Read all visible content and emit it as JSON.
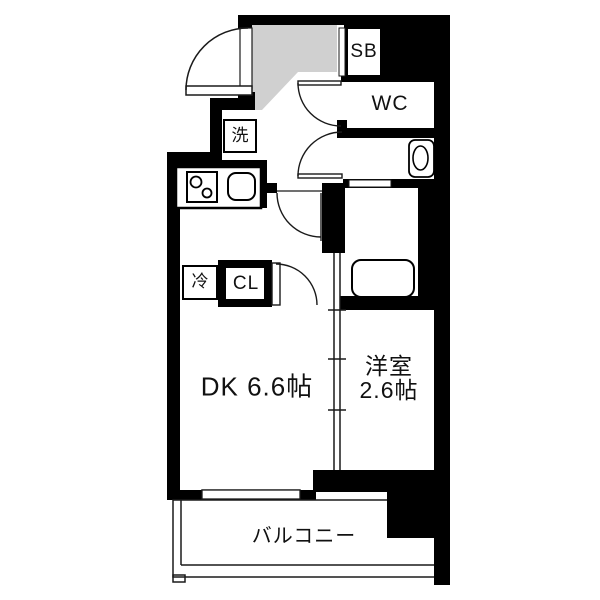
{
  "document": {
    "type": "apartment-floor-plan",
    "orientation": "1DK layout with balcony at bottom"
  },
  "colors": {
    "wall": "#000000",
    "genkan_gray": "#d0d0d0",
    "line": "#1a1a1a",
    "background": "#ffffff"
  },
  "rooms": {
    "dk": {
      "label": "DK 6.6帖"
    },
    "western_room": {
      "line1": "洋室",
      "line2": "2.6帖"
    },
    "balcony": {
      "label": "バルコニー"
    },
    "wc": {
      "label": "WC"
    },
    "shoe_box": {
      "label": "SB"
    },
    "laundry": {
      "label": "洗"
    },
    "refrigerator": {
      "label": "冷"
    },
    "closet": {
      "label": "CL"
    }
  },
  "fixtures": [
    "entrance-genkan-area",
    "entrance-door-swing",
    "wc-door-swing",
    "washroom-door-swing",
    "dk-door-swing",
    "closet-door-swing",
    "kitchen-stove",
    "kitchen-sink",
    "washroom-vanity-basin",
    "bathtub",
    "sliding-partition",
    "balcony-railing",
    "window-to-balcony"
  ]
}
